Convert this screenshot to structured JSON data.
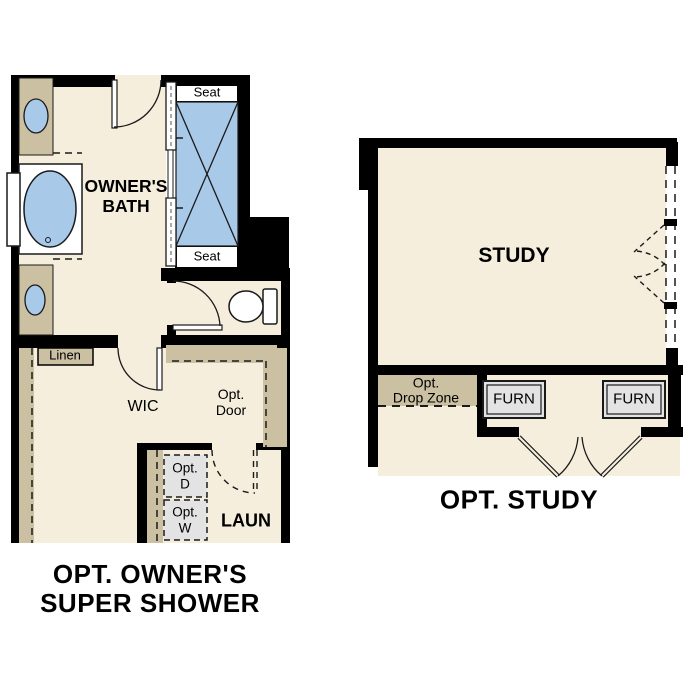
{
  "colors": {
    "wall": "#000000",
    "floor": "#f5eedd",
    "casework_tan": "#ccc0a3",
    "fixture_blue": "#a9c9e8",
    "appliance_gray": "#e3e3e3",
    "fixture_white": "#ffffff",
    "linework": "#1a1a1a"
  },
  "left_plan": {
    "rooms": {
      "bath": {
        "line1": "OWNER'S",
        "line2": "BATH"
      },
      "wic": "WIC",
      "laundry": "LAUN"
    },
    "labels": {
      "seat_top": "Seat",
      "seat_bottom": "Seat",
      "linen": "Linen",
      "opt_door": {
        "line1": "Opt.",
        "line2": "Door"
      },
      "opt_dryer": {
        "line1": "Opt.",
        "line2": "D"
      },
      "opt_washer": {
        "line1": "Opt.",
        "line2": "W"
      }
    },
    "caption": {
      "line1": "OPT. OWNER'S",
      "line2": "SUPER SHOWER"
    }
  },
  "right_plan": {
    "rooms": {
      "study": "STUDY"
    },
    "labels": {
      "drop_zone": {
        "line1": "Opt.",
        "line2": "Drop Zone"
      },
      "furnace_left": "FURN",
      "furnace_right": "FURN"
    },
    "caption": "OPT. STUDY"
  }
}
